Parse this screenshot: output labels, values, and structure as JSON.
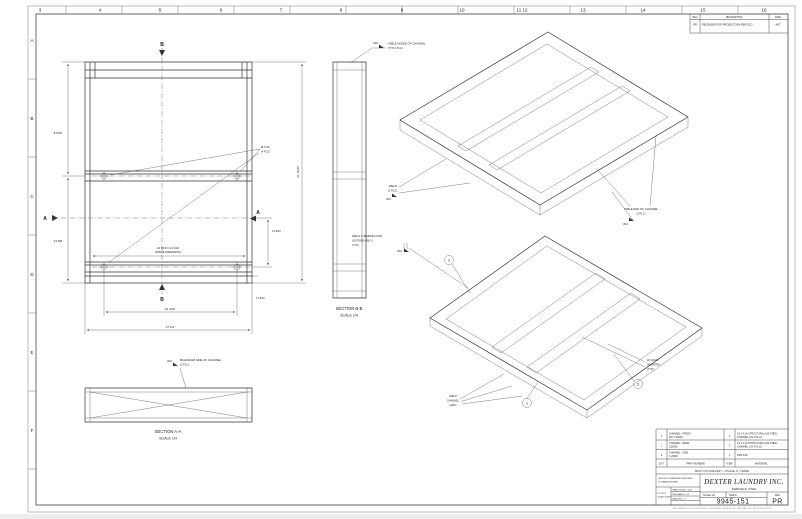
{
  "sheet": {
    "zones_top": [
      "3",
      "4",
      "5",
      "6",
      "7",
      "8",
      "9",
      "10",
      "11 12",
      "13",
      "14",
      "15",
      "16"
    ],
    "zones_left": [
      "A",
      "B",
      "C",
      "D",
      "E",
      "F"
    ]
  },
  "revisions": {
    "col_rev": "REV",
    "col_desc": "DESCRIPTION",
    "col_date": "DATE",
    "row": {
      "rev": "PR",
      "desc": "RELEASED FOR PRODUCTION PER ECO",
      "date": "4/07"
    }
  },
  "front_view": {
    "section_a": "A",
    "section_b": "B",
    "dims": {
      "left_top": "8 5/16",
      "left_bottom": "13 5/8",
      "right": "31 15/16",
      "right_small": "2 13/16",
      "bottom_inner": "21 3/16",
      "bottom_outer": "27 1/2",
      "bottom_right": "1 13/16"
    },
    "hole_callout": {
      "line1": "Ø 7/16",
      "line2": "(4 PLC)"
    },
    "inside_dim": {
      "line1": "24 3/16 X 21 3/16",
      "line2": "(INSIDE DIMENSION)"
    }
  },
  "section_bb": {
    "title": "SECTION B-B",
    "scale": "SCALE 1/4",
    "weld_size": "3/16",
    "callout": {
      "line1": "TABLE INSIDE OF CHANNEL",
      "line2": "(TYP 2 PLC)"
    }
  },
  "section_aa": {
    "title": "SECTION A-A",
    "scale": "SCALE 1/4",
    "weld_size": "3/16",
    "callout": {
      "line1": "BALANCED SIDE OF CHANNEL",
      "line2": "(2 PLC)"
    }
  },
  "iso_top": {
    "weld_left_size": "3/16",
    "callout_left": {
      "line1": "WELD",
      "line2": "(2 PLC)"
    },
    "weld_right_size": "3/16",
    "callout_right": {
      "line1": "TABLE END OF CHANNEL",
      "line2": "(2 PLC)"
    }
  },
  "iso_bottom": {
    "weld_left_size": "3/16",
    "callout_left": {
      "line1": "WELD 3 SIDES/FLOOR",
      "line2": "(OUTSIDE ONLY)",
      "line3": "(TYP)"
    },
    "callout_weld": {
      "line1": "WELD",
      "line2": "CHANNEL",
      "line3": "(ARC)"
    },
    "callout_hole": {
      "line1": "4X HOLE",
      "line2": "INVERTED",
      "line3": "(TYP)"
    },
    "balloon_1": "1",
    "balloon_2": "2",
    "balloon_3": "3"
  },
  "parts_table": {
    "headers": {
      "qty": "QTY",
      "part": "PART NUMBER",
      "item": "ITEM",
      "material": "MATERIAL"
    },
    "rows": [
      {
        "qty": "1",
        "item": "3",
        "part1": "CHANNEL - FRONT,",
        "part2": "WC 7-20060",
        "mat1": "C3 X 4.1# STRUCTURAL A36 STEEL",
        "mat2": "CHANNEL C/S 4.00 LG"
      },
      {
        "qty": "1",
        "item": "2",
        "part1": "CHANNEL - REAR,",
        "part2": "C20060",
        "mat1": "C3 X 4.1# STRUCTURAL A36 STEEL",
        "mat2": "CHANNEL C/S 4.00 LG"
      },
      {
        "qty": "2",
        "item": "1",
        "part1": "CHANNEL - SIDE,",
        "part2": "7-20060",
        "mat1": "HRS 3/16",
        "mat2": ""
      }
    ],
    "note": "MUST CUT DUE ASSY - 1 PLACE, K: 7-30060"
  },
  "title_block": {
    "company": "DEXTER LAUNDRY INC.",
    "city": "FAIRFIELD, IOWA",
    "tol1": "UNLESS OTHERWISE SPECIFIED",
    "tol2": "TOLERANCES ARE:",
    "tol3": "FRACTIONS ± 1/16",
    "tol4": "DECIMALS ± .01",
    "tol5": "ANGLES ± 1°",
    "left1": "DO NOT",
    "left2": "SCALE DWG",
    "scale": "SCALE 1/4",
    "size": "SIZE D",
    "rev_label": "REV",
    "part_number": "9945-151",
    "rev": "PR",
    "fine_print": "THIS DRAWING IS THE PROPERTY OF DEXTER LAUNDRY INC. AND MAY NOT BE REPRODUCED"
  }
}
